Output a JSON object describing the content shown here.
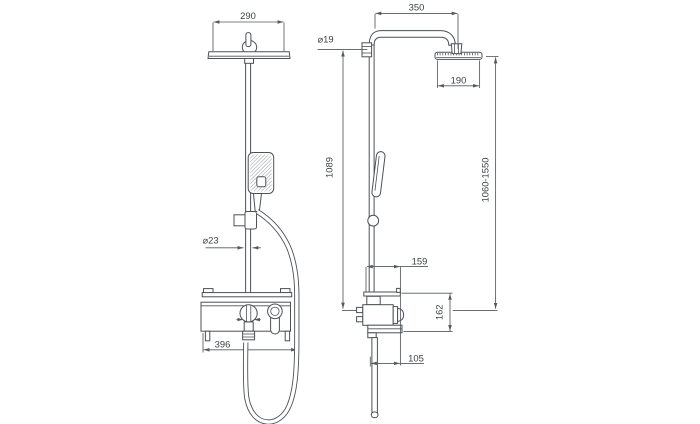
{
  "page": {
    "background": "#ffffff",
    "line_color": "#4d5156",
    "dimension_line_color": "#55595e",
    "text_color": "#3c4044"
  },
  "drawing": {
    "kind": "technical dimension drawing of a shower column with mixer, front and side views",
    "views": [
      "front",
      "side"
    ],
    "units_shown": false
  },
  "dimensions": {
    "front_head_width": "290",
    "front_riser_diameter": "⌀23",
    "front_mixer_width": "396",
    "side_arm_length": "350",
    "side_pipe_diameter": "⌀19",
    "side_head_width": "190",
    "side_riser_height": "1089",
    "side_height_range": "1060-1550",
    "side_shelf_depth": "159",
    "side_mixer_height": "162",
    "side_spout_depth": "105"
  }
}
